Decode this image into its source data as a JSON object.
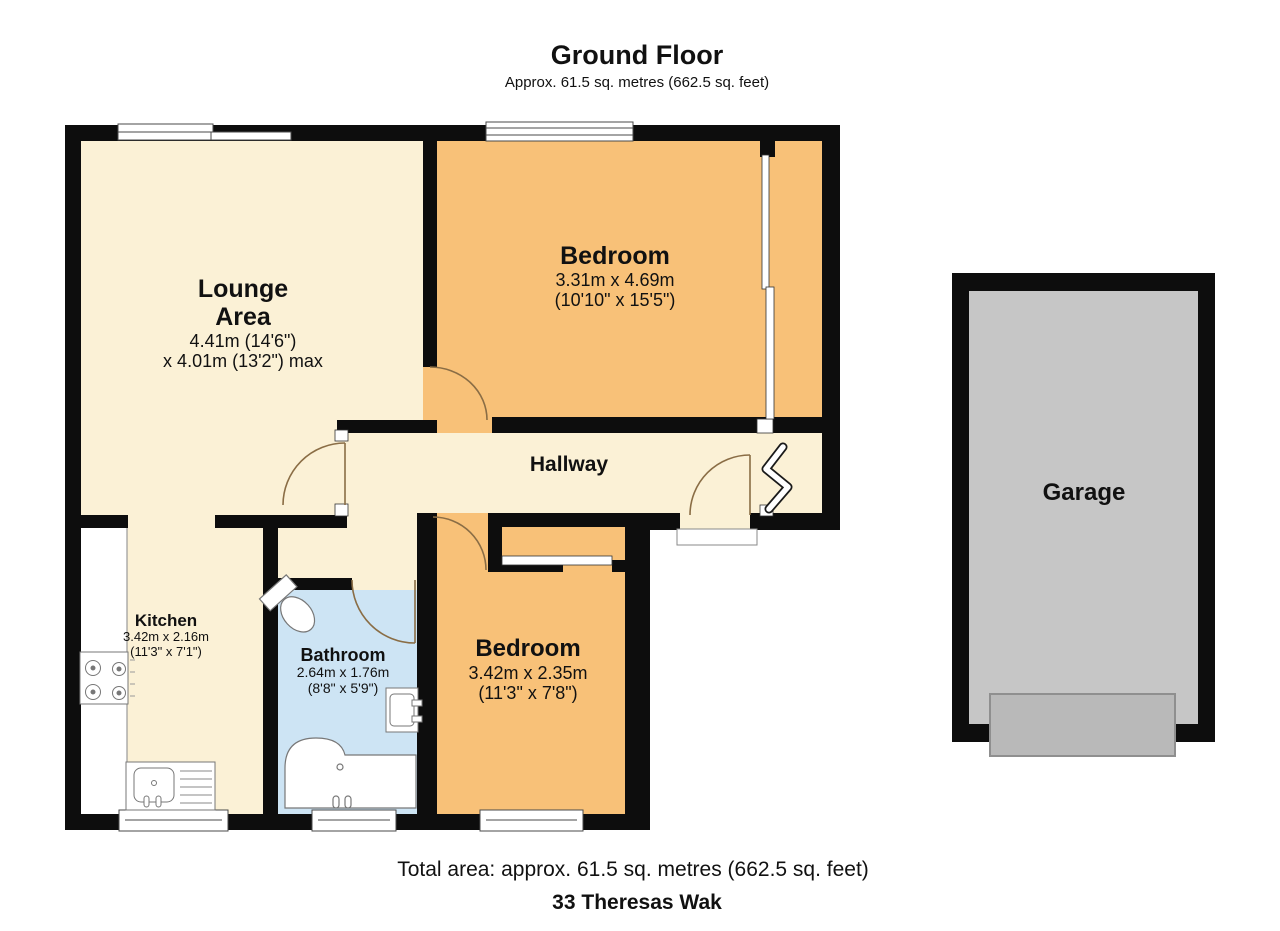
{
  "title": "Ground Floor",
  "subtitle": "Approx. 61.5 sq. metres (662.5 sq. feet)",
  "rooms": {
    "lounge": {
      "name": "Lounge",
      "name2": "Area",
      "dim1": "4.41m (14'6\")",
      "dim2": "x 4.01m (13'2\") max"
    },
    "bedroom1": {
      "name": "Bedroom",
      "dim1": "3.31m x 4.69m",
      "dim2": "(10'10\" x 15'5\")"
    },
    "hallway": {
      "name": "Hallway"
    },
    "kitchen": {
      "name": "Kitchen",
      "dim1": "3.42m x 2.16m",
      "dim2": "(11'3\" x 7'1\")"
    },
    "bathroom": {
      "name": "Bathroom",
      "dim1": "2.64m x 1.76m",
      "dim2": "(8'8\" x 5'9\")"
    },
    "bedroom2": {
      "name": "Bedroom",
      "dim1": "3.42m x 2.35m",
      "dim2": "(11'3\" x 7'8\")"
    },
    "garage": {
      "name": "Garage"
    }
  },
  "footer": {
    "total_area": "Total area: approx. 61.5 sq. metres (662.5 sq. feet)",
    "address": "33 Theresas Wak"
  },
  "colors": {
    "wall": "#0d0d0d",
    "cream": "#fbf1d6",
    "orange": "#f8c178",
    "blue": "#cde4f4",
    "garage_gray": "#c6c6c6",
    "garage_door": "#b9b9b9",
    "door_arc": "#8a6d45"
  }
}
